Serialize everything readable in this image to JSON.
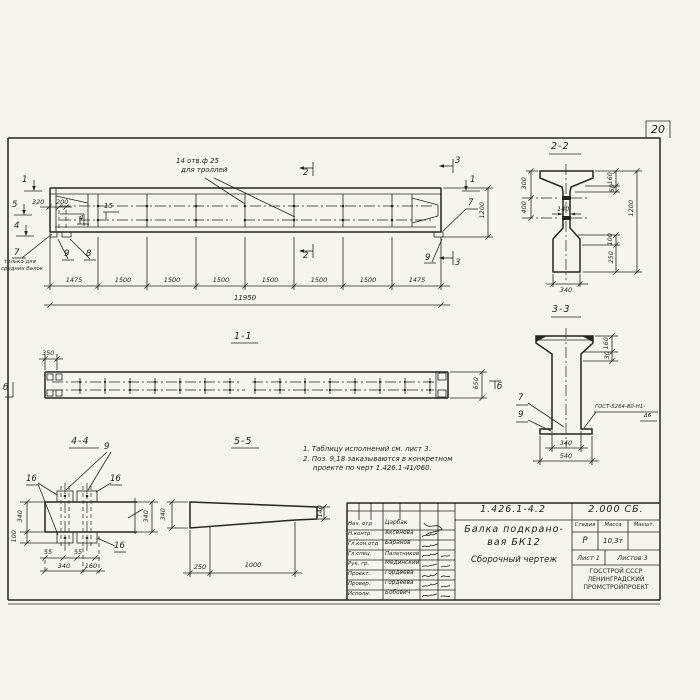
{
  "paper_color": "#f5f4ef",
  "ink_color": "#26241f",
  "page": {
    "sheet_number": "20"
  },
  "elevation": {
    "marker_1": "1",
    "marker_5": "5",
    "marker_4": "4",
    "marker_2": "2",
    "marker_3": "3",
    "dim_320": "320",
    "dim_200": "200",
    "dim_1200": "1200",
    "pos_15": "15",
    "pos_4": "4",
    "pos_7": "7",
    "pos_8": "8",
    "pos_9": "9",
    "pos_7_note_line1": "только для",
    "pos_7_note_line2": "средних балок",
    "holes_note_line1": "14 отв.ф 25",
    "holes_note_line2": "для троллей",
    "segments": [
      "1475",
      "1500",
      "1500",
      "1500",
      "1500",
      "1500",
      "1500",
      "1475"
    ],
    "total_length": "11950"
  },
  "view_1_1": {
    "title": "1-1",
    "dim_350": "350",
    "dim_650": "650",
    "marker": "б"
  },
  "section_2_2": {
    "title": "2-2",
    "dim_300": "300",
    "dim_400": "400",
    "dim_140": "140",
    "dim_160": "160",
    "dim_50": "50",
    "dim_1200": "1200",
    "dim_100": "100",
    "dim_250": "250",
    "dim_340": "340"
  },
  "section_3_3": {
    "title": "3-3",
    "dim_160": "160",
    "dim_30": "30",
    "dim_340": "340",
    "dim_540": "540",
    "pos_7": "7",
    "pos_9": "9",
    "weld_note_line1": "ГОСТ-5264-80-Н1-",
    "weld_note_line2": "Δ6"
  },
  "view_4_4": {
    "title": "4-4",
    "pos_9": "9",
    "pos_16": "16",
    "dim_340_left": "340",
    "dim_100": "100",
    "dim_55": "55",
    "dim_340_bottom": "340",
    "dim_160": "160",
    "dim_340_right": "340"
  },
  "view_5_5": {
    "title": "5-5",
    "dim_340": "340",
    "dim_140": "140",
    "dim_250": "250",
    "dim_1000": "1000"
  },
  "notes": {
    "line1": "1. Таблицу исполнений см. лист 3.",
    "line2": "2. Поз. 9,18 заказываются в конкретном",
    "line3": "проекте по черт 1.426.1-41/060."
  },
  "title_block": {
    "doc_number": "1.426.1-4.2",
    "doc_code": "2.000 СБ.",
    "title_line1": "Балка подкрано-",
    "title_line2": "вая БК12",
    "title_line3": "Сборочный чертеж",
    "stage_header": "Стадия",
    "mass_header": "Масса",
    "scale_header": "Масшт.",
    "stage_value": "Р",
    "mass_value": "10,3т",
    "sheet_label": "Лист 1",
    "sheets_label": "Листов 3",
    "org_line1": "ГОССТРОЙ СССР",
    "org_line2": "ЛЕНИНГРАДСКИЙ",
    "org_line3": "ПРОМСТРОЙПРОЕКТ",
    "personnel": [
      {
        "role": "Нач. отд",
        "name": "Царбак"
      },
      {
        "role": "Н.контр.",
        "name": "Аксенова"
      },
      {
        "role": "Гл.кон.отд",
        "name": "Баранов"
      },
      {
        "role": "Гл.спец.",
        "name": "Палатников"
      },
      {
        "role": "Рук. гр.",
        "name": "Мединский"
      },
      {
        "role": "Проект.",
        "name": "Гордеева"
      },
      {
        "role": "Провер.",
        "name": "Гордеева"
      },
      {
        "role": "Исполн.",
        "name": "Бобович"
      }
    ]
  }
}
